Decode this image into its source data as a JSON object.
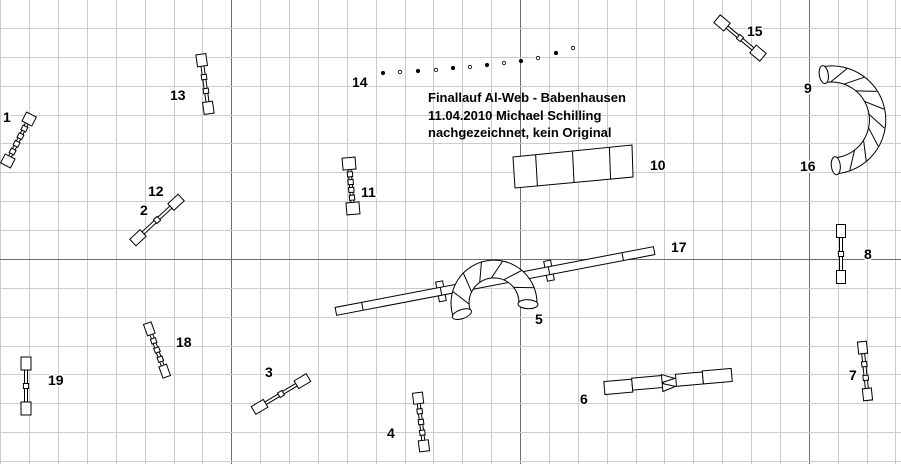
{
  "title": {
    "line1": "Finallauf Al-Web - Babenhausen",
    "line2": "11.04.2010 Michael Schilling",
    "line3": "nachgezeichnet, kein Original"
  },
  "colors": {
    "background": "#ffffff",
    "grid_minor": "#cccccc",
    "grid_major": "#6e6e6e",
    "outline": "#000000",
    "fill": "#ffffff",
    "label": "#000000",
    "label_halo": "#ffffff"
  },
  "grid": {
    "spacing": 28.87,
    "x0": 0.4,
    "y0": -0.9,
    "major_cols": [
      8,
      18,
      28
    ],
    "major_rows": [
      9
    ]
  },
  "labels": [
    {
      "t": "1",
      "x": 3,
      "y": 122
    },
    {
      "t": "2",
      "x": 140,
      "y": 215
    },
    {
      "t": "3",
      "x": 265,
      "y": 377
    },
    {
      "t": "4",
      "x": 387,
      "y": 438
    },
    {
      "t": "5",
      "x": 535,
      "y": 324
    },
    {
      "t": "6",
      "x": 580,
      "y": 404
    },
    {
      "t": "7",
      "x": 849,
      "y": 380
    },
    {
      "t": "8",
      "x": 864,
      "y": 259
    },
    {
      "t": "9",
      "x": 804,
      "y": 93
    },
    {
      "t": "10",
      "x": 650,
      "y": 170
    },
    {
      "t": "11",
      "x": 361,
      "y": 197
    },
    {
      "t": "12",
      "x": 148,
      "y": 196
    },
    {
      "t": "13",
      "x": 170,
      "y": 100
    },
    {
      "t": "14",
      "x": 352,
      "y": 87
    },
    {
      "t": "15",
      "x": 747,
      "y": 36
    },
    {
      "t": "16",
      "x": 800,
      "y": 171
    },
    {
      "t": "17",
      "x": 671,
      "y": 252
    },
    {
      "t": "18",
      "x": 176,
      "y": 347
    },
    {
      "t": "19",
      "x": 48,
      "y": 385
    }
  ],
  "obstacles": {
    "jumps": [
      {
        "id": "1",
        "cx": 18.5,
        "cy": 140,
        "angle": -63,
        "len": 57,
        "capA": 10,
        "capP": 11,
        "bands": 4
      },
      {
        "id": "2-12",
        "cx": 157,
        "cy": 220,
        "angle": -43,
        "len": 66,
        "capA": 14,
        "capP": 9,
        "bands": 1
      },
      {
        "id": "3",
        "cx": 281,
        "cy": 394,
        "angle": -31,
        "len": 64,
        "capA": 14,
        "capP": 9,
        "bands": 1
      },
      {
        "id": "4",
        "cx": 421,
        "cy": 422,
        "angle": 83,
        "len": 59,
        "capA": 11,
        "capP": 10,
        "bands": 3
      },
      {
        "id": "7",
        "cx": 865,
        "cy": 371,
        "angle": 84,
        "len": 59,
        "capA": 12,
        "capP": 9,
        "bands": 2
      },
      {
        "id": "8",
        "cx": 841,
        "cy": 254,
        "angle": 90,
        "len": 59,
        "capA": 13,
        "capP": 9,
        "bands": 1
      },
      {
        "id": "11",
        "cx": 351,
        "cy": 186,
        "angle": 85,
        "len": 57,
        "capA": 12,
        "capP": 13,
        "bands": 4
      },
      {
        "id": "13",
        "cx": 205,
        "cy": 84,
        "angle": 82,
        "len": 60,
        "capA": 12,
        "capP": 10,
        "bands": 2
      },
      {
        "id": "15",
        "cx": 740,
        "cy": 38,
        "angle": 40,
        "len": 60,
        "capA": 13,
        "capP": 10,
        "bands": 1
      },
      {
        "id": "18",
        "cx": 157,
        "cy": 350,
        "angle": 70,
        "len": 57,
        "capA": 12,
        "capP": 8,
        "bands": 3
      },
      {
        "id": "19",
        "cx": 26,
        "cy": 386,
        "angle": 90,
        "len": 58,
        "capA": 13,
        "capP": 10,
        "bands": 1
      }
    ],
    "curved_tunnels": [
      {
        "id": "5",
        "cx": 494,
        "cy": 303,
        "rOut": 43,
        "rIn": 25,
        "angStart": 199,
        "angEnd": -2,
        "hatches": 6
      },
      {
        "id": "9-16",
        "cx": 831,
        "cy": 120,
        "rOut": 54,
        "rIn": 38,
        "angStart": 99,
        "angEnd": -84,
        "hatches": 8
      }
    ],
    "straight_tunnel": {
      "id": "6",
      "cx": 668,
      "cy": 381,
      "angle": -5,
      "segments": [
        [
          -64,
          -5,
          28,
          13
        ],
        [
          -36,
          -6,
          31,
          12
        ],
        [
          8,
          -6,
          27,
          12
        ],
        [
          35,
          -7,
          29,
          13
        ]
      ],
      "chevrons": [
        [
          [
            -6,
            -7
          ],
          [
            7,
            -2
          ],
          [
            -6,
            1
          ]
        ],
        [
          [
            -6,
            2
          ],
          [
            7,
            6
          ],
          [
            -6,
            10
          ]
        ]
      ]
    },
    "dog_walk": {
      "id": "17",
      "cx": 495,
      "cy": 281,
      "angle": -10.8,
      "halfLen": 162,
      "halfWidth": 4,
      "joints": [
        -135,
        -55,
        55,
        130
      ],
      "ticks": [
        -55,
        55
      ],
      "tickW": 7,
      "tickH": 20
    },
    "long_jump": {
      "id": "10",
      "points": [
        [
          513,
          157
        ],
        [
          632,
          145
        ],
        [
          633,
          177
        ],
        [
          515,
          188
        ]
      ],
      "dividers": [
        0.19,
        0.5,
        0.81
      ]
    },
    "weave": {
      "id": "14",
      "r": 1.7,
      "points": [
        [
          383,
          73
        ],
        [
          400,
          72
        ],
        [
          418,
          71
        ],
        [
          436,
          70
        ],
        [
          453,
          68
        ],
        [
          470,
          67
        ],
        [
          487,
          65
        ],
        [
          504,
          63
        ],
        [
          521,
          61
        ],
        [
          538,
          58
        ],
        [
          556,
          53
        ],
        [
          573,
          48
        ]
      ]
    }
  }
}
